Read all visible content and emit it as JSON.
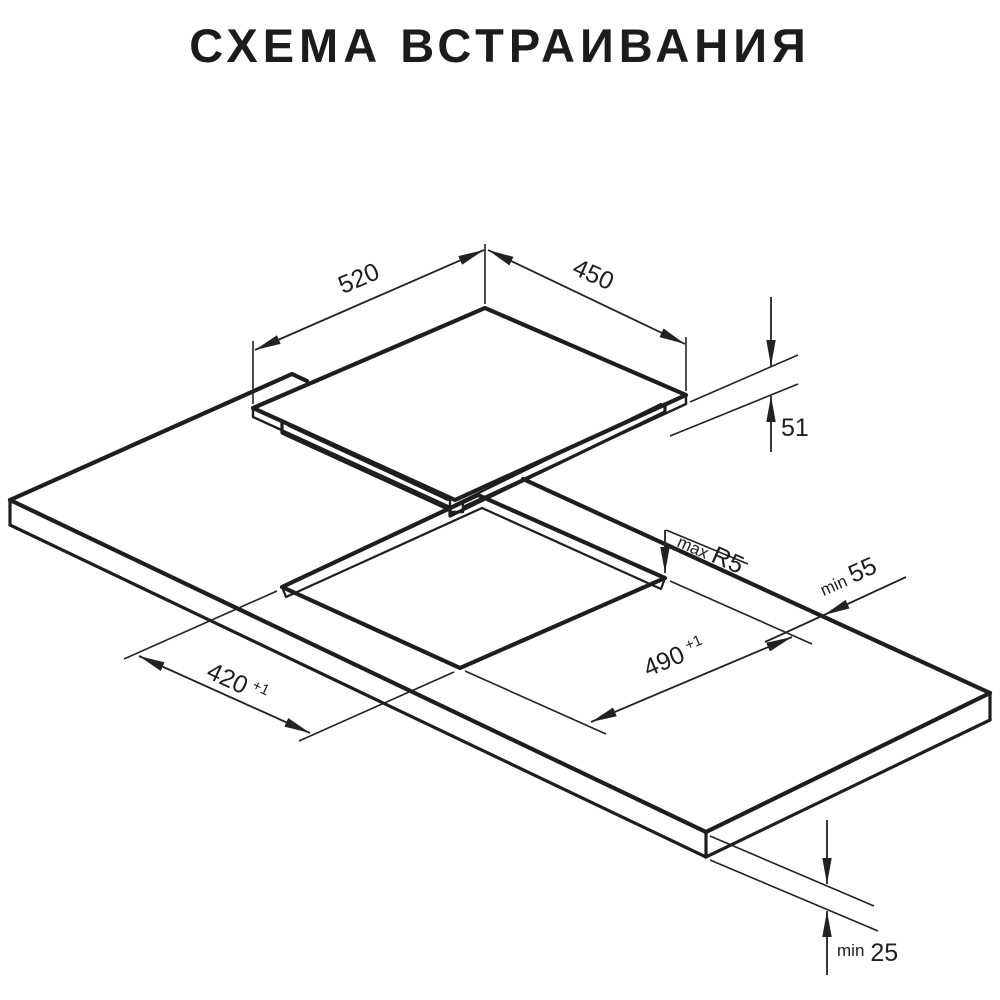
{
  "title": "СХЕМА ВСТРАИВАНИЯ",
  "dimensions": {
    "cooktop_width": {
      "value": "520"
    },
    "cooktop_depth": {
      "value": "450"
    },
    "cooktop_height": {
      "value": "51"
    },
    "cutout_width": {
      "value": "490",
      "tolerance": "+1"
    },
    "cutout_depth": {
      "value": "420",
      "tolerance": "+1"
    },
    "corner_radius": {
      "prefix": "max",
      "value": "R5"
    },
    "rear_clearance": {
      "prefix": "min",
      "value": "55"
    },
    "bottom_clearance": {
      "prefix": "min",
      "value": "25"
    }
  }
}
